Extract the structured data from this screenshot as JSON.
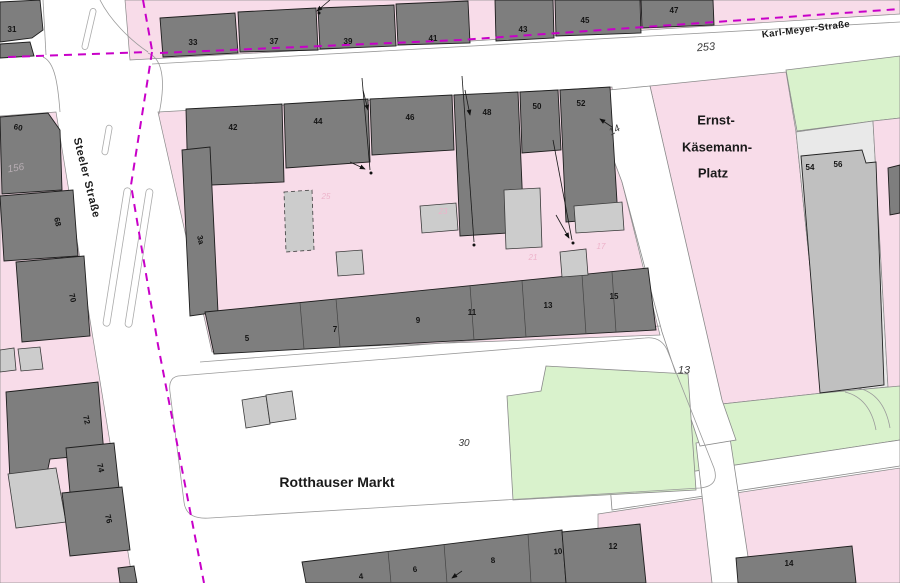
{
  "map_title": "Cadastral map — Rotthauser Markt",
  "colors": {
    "parcel_pink": "#f8dce9",
    "area_green": "#d9f2cc",
    "building_dark": "#7e7e7e",
    "building_medium": "#c0c0c0",
    "building_light": "#cccccc",
    "parcel_gray": "#e9e9e9",
    "boundary_magenta": "#c800c8",
    "line_gray": "#9a9a9a"
  },
  "labels": [
    {
      "id": "steeler-strasse",
      "text": "Steeler Straße",
      "x": 86,
      "y": 178,
      "rot": 76,
      "cls": "street"
    },
    {
      "id": "karl-meyer-strasse",
      "text": "Karl-Meyer-Straße",
      "x": 806,
      "y": 30,
      "rot": -7,
      "cls": "street-sm"
    },
    {
      "id": "ernst-line1",
      "text": "Ernst-",
      "x": 716,
      "y": 120,
      "rot": 0,
      "cls": "area"
    },
    {
      "id": "ernst-line2",
      "text": "Käsemann-",
      "x": 717,
      "y": 147,
      "rot": 0,
      "cls": "area"
    },
    {
      "id": "ernst-line3",
      "text": "Platz",
      "x": 713,
      "y": 173,
      "rot": 0,
      "cls": "area"
    },
    {
      "id": "rotthauser-markt",
      "text": "Rotthauser Markt",
      "x": 337,
      "y": 482,
      "rot": 0,
      "cls": "area-lg"
    },
    {
      "id": "parcel-253",
      "text": "253",
      "x": 706,
      "y": 48,
      "rot": -5,
      "cls": "parcel"
    },
    {
      "id": "parcel-14",
      "text": "14",
      "x": 615,
      "y": 131,
      "rot": -30,
      "cls": "parcel-sm"
    },
    {
      "id": "parcel-13",
      "text": "13",
      "x": 684,
      "y": 371,
      "rot": 0,
      "cls": "parcel"
    },
    {
      "id": "parcel-30",
      "text": "30",
      "x": 464,
      "y": 444,
      "rot": 0,
      "cls": "parcel-sm"
    },
    {
      "id": "parcel-156",
      "text": "156",
      "x": 16,
      "y": 169,
      "rot": -10,
      "cls": "parcel-faint"
    },
    {
      "id": "bld-31",
      "text": "31",
      "x": 12,
      "y": 30,
      "rot": 0,
      "cls": "bld"
    },
    {
      "id": "bld-33",
      "text": "33",
      "x": 193,
      "y": 43,
      "rot": 0,
      "cls": "bld"
    },
    {
      "id": "bld-37",
      "text": "37",
      "x": 274,
      "y": 42,
      "rot": 0,
      "cls": "bld"
    },
    {
      "id": "bld-39",
      "text": "39",
      "x": 348,
      "y": 42,
      "rot": 0,
      "cls": "bld"
    },
    {
      "id": "bld-41",
      "text": "41",
      "x": 433,
      "y": 39,
      "rot": 0,
      "cls": "bld"
    },
    {
      "id": "bld-43",
      "text": "43",
      "x": 523,
      "y": 30,
      "rot": 0,
      "cls": "bld"
    },
    {
      "id": "bld-45",
      "text": "45",
      "x": 585,
      "y": 21,
      "rot": 0,
      "cls": "bld"
    },
    {
      "id": "bld-47",
      "text": "47",
      "x": 674,
      "y": 11,
      "rot": 0,
      "cls": "bld"
    },
    {
      "id": "bld-42",
      "text": "42",
      "x": 233,
      "y": 128,
      "rot": 0,
      "cls": "bld"
    },
    {
      "id": "bld-44",
      "text": "44",
      "x": 318,
      "y": 122,
      "rot": 0,
      "cls": "bld"
    },
    {
      "id": "bld-46",
      "text": "46",
      "x": 410,
      "y": 118,
      "rot": 0,
      "cls": "bld"
    },
    {
      "id": "bld-48",
      "text": "48",
      "x": 487,
      "y": 113,
      "rot": 0,
      "cls": "bld"
    },
    {
      "id": "bld-50",
      "text": "50",
      "x": 537,
      "y": 107,
      "rot": 0,
      "cls": "bld"
    },
    {
      "id": "bld-52",
      "text": "52",
      "x": 581,
      "y": 104,
      "rot": 0,
      "cls": "bld"
    },
    {
      "id": "bld-5",
      "text": "5",
      "x": 247,
      "y": 339,
      "rot": 0,
      "cls": "bld"
    },
    {
      "id": "bld-7",
      "text": "7",
      "x": 335,
      "y": 330,
      "rot": 0,
      "cls": "bld"
    },
    {
      "id": "bld-9",
      "text": "9",
      "x": 418,
      "y": 321,
      "rot": 0,
      "cls": "bld"
    },
    {
      "id": "bld-11",
      "text": "11",
      "x": 472,
      "y": 313,
      "rot": 0,
      "cls": "bld"
    },
    {
      "id": "bld-13",
      "text": "13",
      "x": 548,
      "y": 306,
      "rot": 0,
      "cls": "bld"
    },
    {
      "id": "bld-15",
      "text": "15",
      "x": 614,
      "y": 297,
      "rot": 0,
      "cls": "bld"
    },
    {
      "id": "bld-54",
      "text": "54",
      "x": 810,
      "y": 168,
      "rot": 0,
      "cls": "bld"
    },
    {
      "id": "bld-56",
      "text": "56",
      "x": 838,
      "y": 165,
      "rot": 0,
      "cls": "bld"
    },
    {
      "id": "bld-60",
      "text": "60",
      "x": 18,
      "y": 128,
      "rot": 12,
      "cls": "bld"
    },
    {
      "id": "bld-68",
      "text": "68",
      "x": 57,
      "y": 222,
      "rot": 76,
      "cls": "bld"
    },
    {
      "id": "bld-70",
      "text": "70",
      "x": 72,
      "y": 298,
      "rot": 76,
      "cls": "bld"
    },
    {
      "id": "bld-3a",
      "text": "3a",
      "x": 200,
      "y": 240,
      "rot": 76,
      "cls": "bld"
    },
    {
      "id": "bld-72",
      "text": "72",
      "x": 86,
      "y": 420,
      "rot": 76,
      "cls": "bld"
    },
    {
      "id": "bld-74",
      "text": "74",
      "x": 100,
      "y": 468,
      "rot": 76,
      "cls": "bld"
    },
    {
      "id": "bld-76",
      "text": "76",
      "x": 108,
      "y": 519,
      "rot": 76,
      "cls": "bld"
    },
    {
      "id": "bld-4",
      "text": "4",
      "x": 361,
      "y": 577,
      "rot": -5,
      "cls": "bld"
    },
    {
      "id": "bld-6",
      "text": "6",
      "x": 415,
      "y": 570,
      "rot": -5,
      "cls": "bld"
    },
    {
      "id": "bld-8",
      "text": "8",
      "x": 493,
      "y": 561,
      "rot": -5,
      "cls": "bld"
    },
    {
      "id": "bld-10",
      "text": "10",
      "x": 558,
      "y": 552,
      "rot": -5,
      "cls": "bld"
    },
    {
      "id": "bld-12",
      "text": "12",
      "x": 613,
      "y": 547,
      "rot": 0,
      "cls": "bld"
    },
    {
      "id": "bld-14b",
      "text": "14",
      "x": 789,
      "y": 564,
      "rot": 0,
      "cls": "bld"
    },
    {
      "id": "faint-25",
      "text": "25",
      "x": 326,
      "y": 197,
      "rot": 0,
      "cls": "faint"
    },
    {
      "id": "faint-23",
      "text": "23",
      "x": 443,
      "y": 212,
      "rot": 0,
      "cls": "faint"
    },
    {
      "id": "faint-21",
      "text": "21",
      "x": 533,
      "y": 258,
      "rot": 0,
      "cls": "faint"
    },
    {
      "id": "faint-17",
      "text": "17",
      "x": 601,
      "y": 247,
      "rot": 0,
      "cls": "faint"
    }
  ]
}
